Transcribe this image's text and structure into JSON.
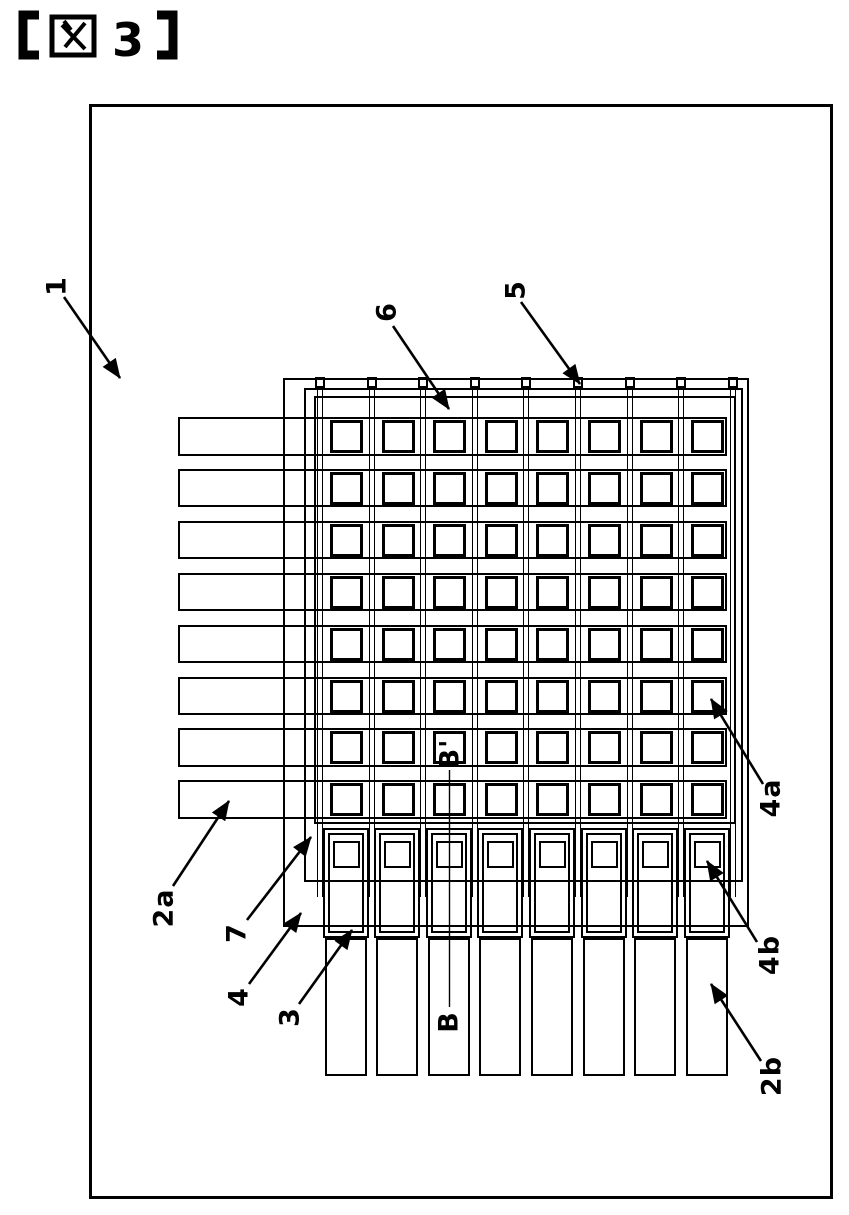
{
  "figure": {
    "title": "【図3】",
    "number": "3",
    "bracket_open": "【",
    "bracket_close": "】",
    "kanji": "図"
  },
  "labels": [
    {
      "id": "1",
      "text": "1"
    },
    {
      "id": "2a",
      "text": "2a"
    },
    {
      "id": "2b",
      "text": "2b"
    },
    {
      "id": "3",
      "text": "3"
    },
    {
      "id": "4",
      "text": "4"
    },
    {
      "id": "4a",
      "text": "4a"
    },
    {
      "id": "4b",
      "text": "4b"
    },
    {
      "id": "5",
      "text": "5"
    },
    {
      "id": "6",
      "text": "6"
    },
    {
      "id": "7",
      "text": "7"
    },
    {
      "id": "B",
      "text": "B"
    },
    {
      "id": "Bp",
      "text": "B'"
    }
  ],
  "structure": {
    "grid_rows": 8,
    "grid_cols": 8,
    "row_electrodes": 8,
    "column_wires": 9,
    "bottom_pads": 8,
    "bottom_terminal_bars": 8,
    "left_terminal_bars": 8,
    "section_line": "B-B'"
  },
  "colors": {
    "line": "#000000",
    "background": "#ffffff"
  }
}
